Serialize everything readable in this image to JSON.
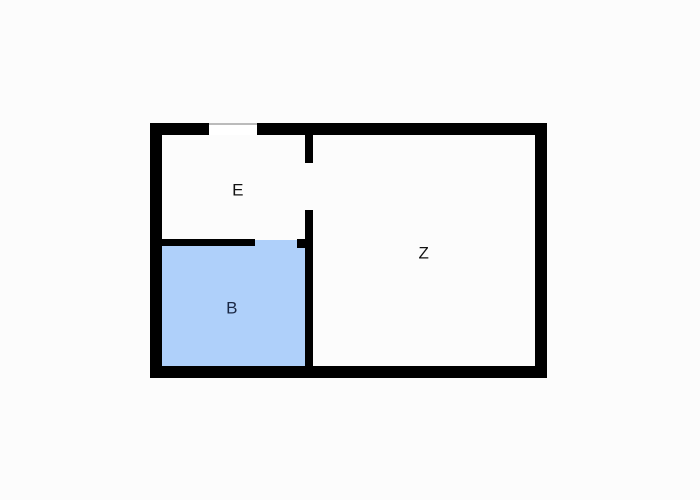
{
  "diagram_type": "floor-plan",
  "colors": {
    "background": "#fcfcfc",
    "wall": "#000000",
    "room_b_fill": "#afd0fa",
    "label": "#111111",
    "label_b": "#1a2744",
    "door_line": "#bbbbbb"
  },
  "rooms": [
    {
      "id": "E",
      "label": "E",
      "fill": "white",
      "position": "top-left"
    },
    {
      "id": "B",
      "label": "B",
      "fill": "#afd0fa",
      "position": "bottom-left"
    },
    {
      "id": "Z",
      "label": "Z",
      "fill": "white",
      "position": "right"
    }
  ],
  "openings": [
    {
      "name": "entry-opening",
      "location": "top outer wall above room E"
    },
    {
      "name": "door-e-z",
      "location": "interior vertical wall between E and Z"
    },
    {
      "name": "door-e-b",
      "location": "right end of divider wall between E and B"
    }
  ]
}
